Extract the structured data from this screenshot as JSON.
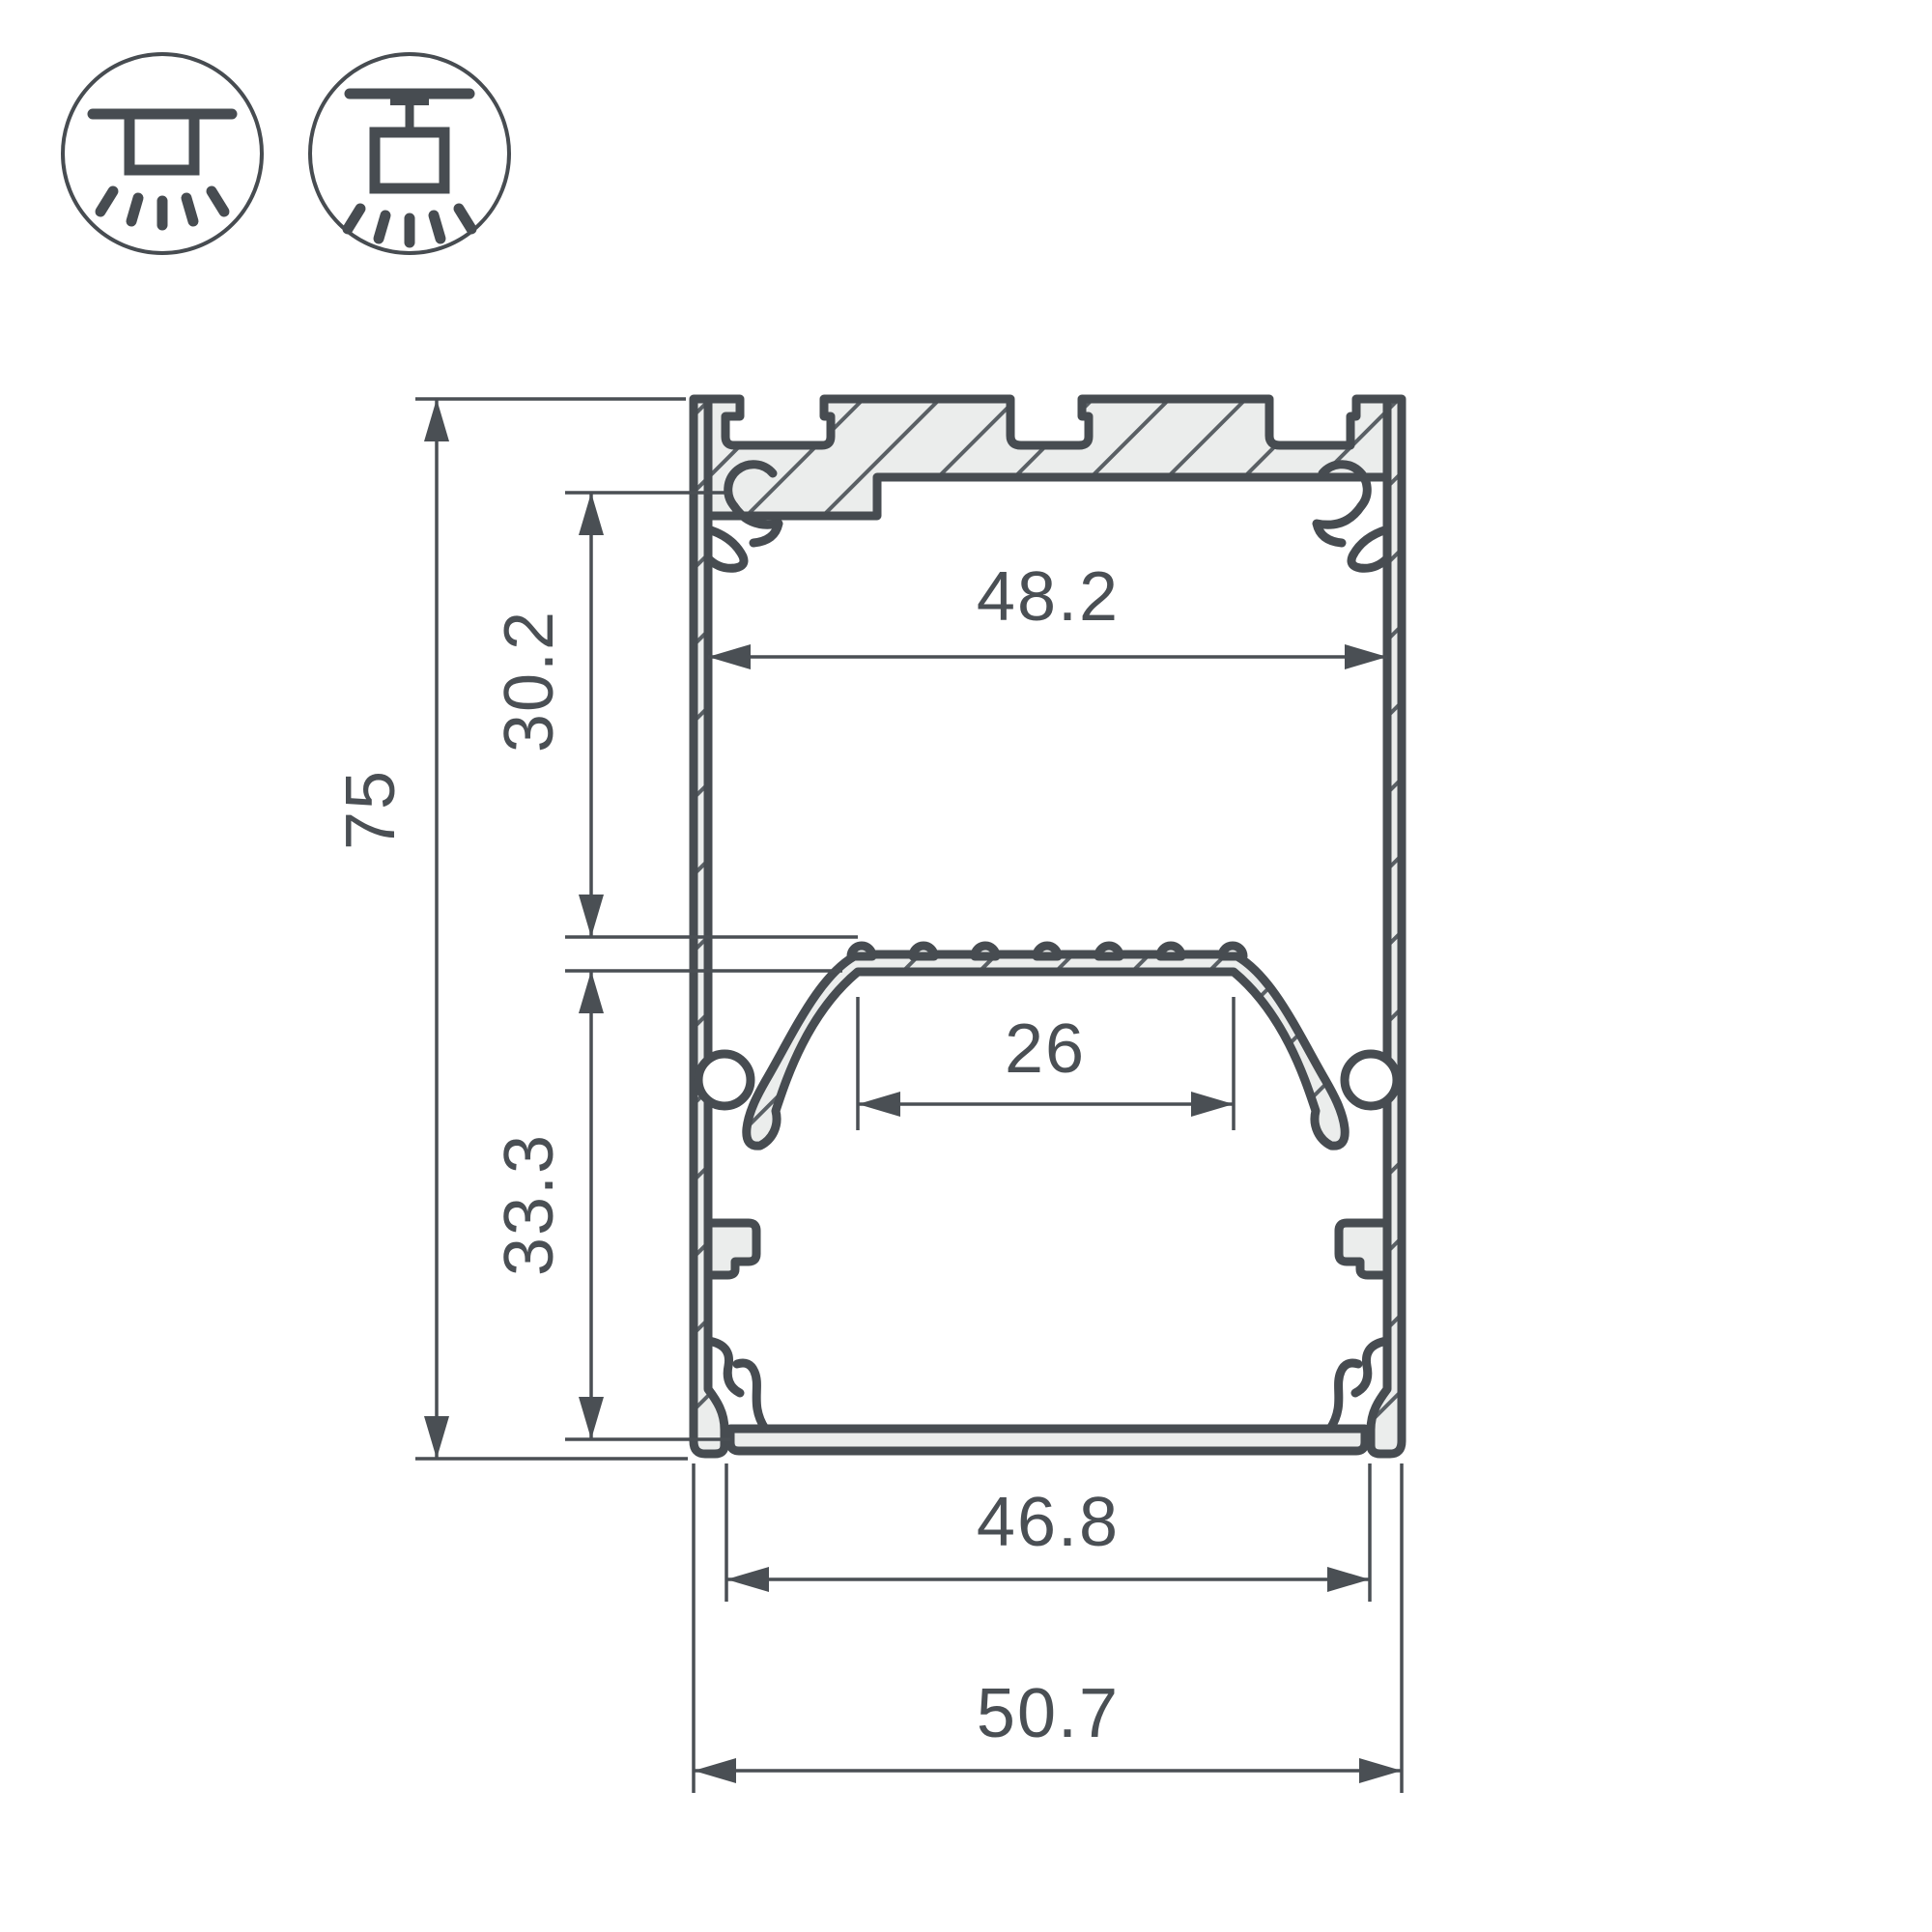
{
  "diagram": {
    "kind": "technical-drawing",
    "subject": "aluminum LED profile cross-section with dimension callouts",
    "background": "#ffffff",
    "line_color": "#474c51",
    "fill_color": "#ebedec",
    "dim_color": "#4a4f54"
  },
  "icons": {
    "surface_mount": "surface-mount-light-icon",
    "pendant_mount": "pendant-mount-light-icon"
  },
  "dimensions": {
    "overall_height": {
      "value": "75",
      "orientation": "vertical"
    },
    "upper_inner_height": {
      "value": "30.2",
      "orientation": "vertical"
    },
    "lower_inner_height": {
      "value": "33.3",
      "orientation": "vertical"
    },
    "inner_width_top": {
      "value": "48.2",
      "orientation": "horizontal"
    },
    "led_shelf_width": {
      "value": "26",
      "orientation": "horizontal"
    },
    "bottom_opening_width": {
      "value": "46.8",
      "orientation": "horizontal"
    },
    "overall_width": {
      "value": "50.7",
      "orientation": "horizontal"
    }
  }
}
